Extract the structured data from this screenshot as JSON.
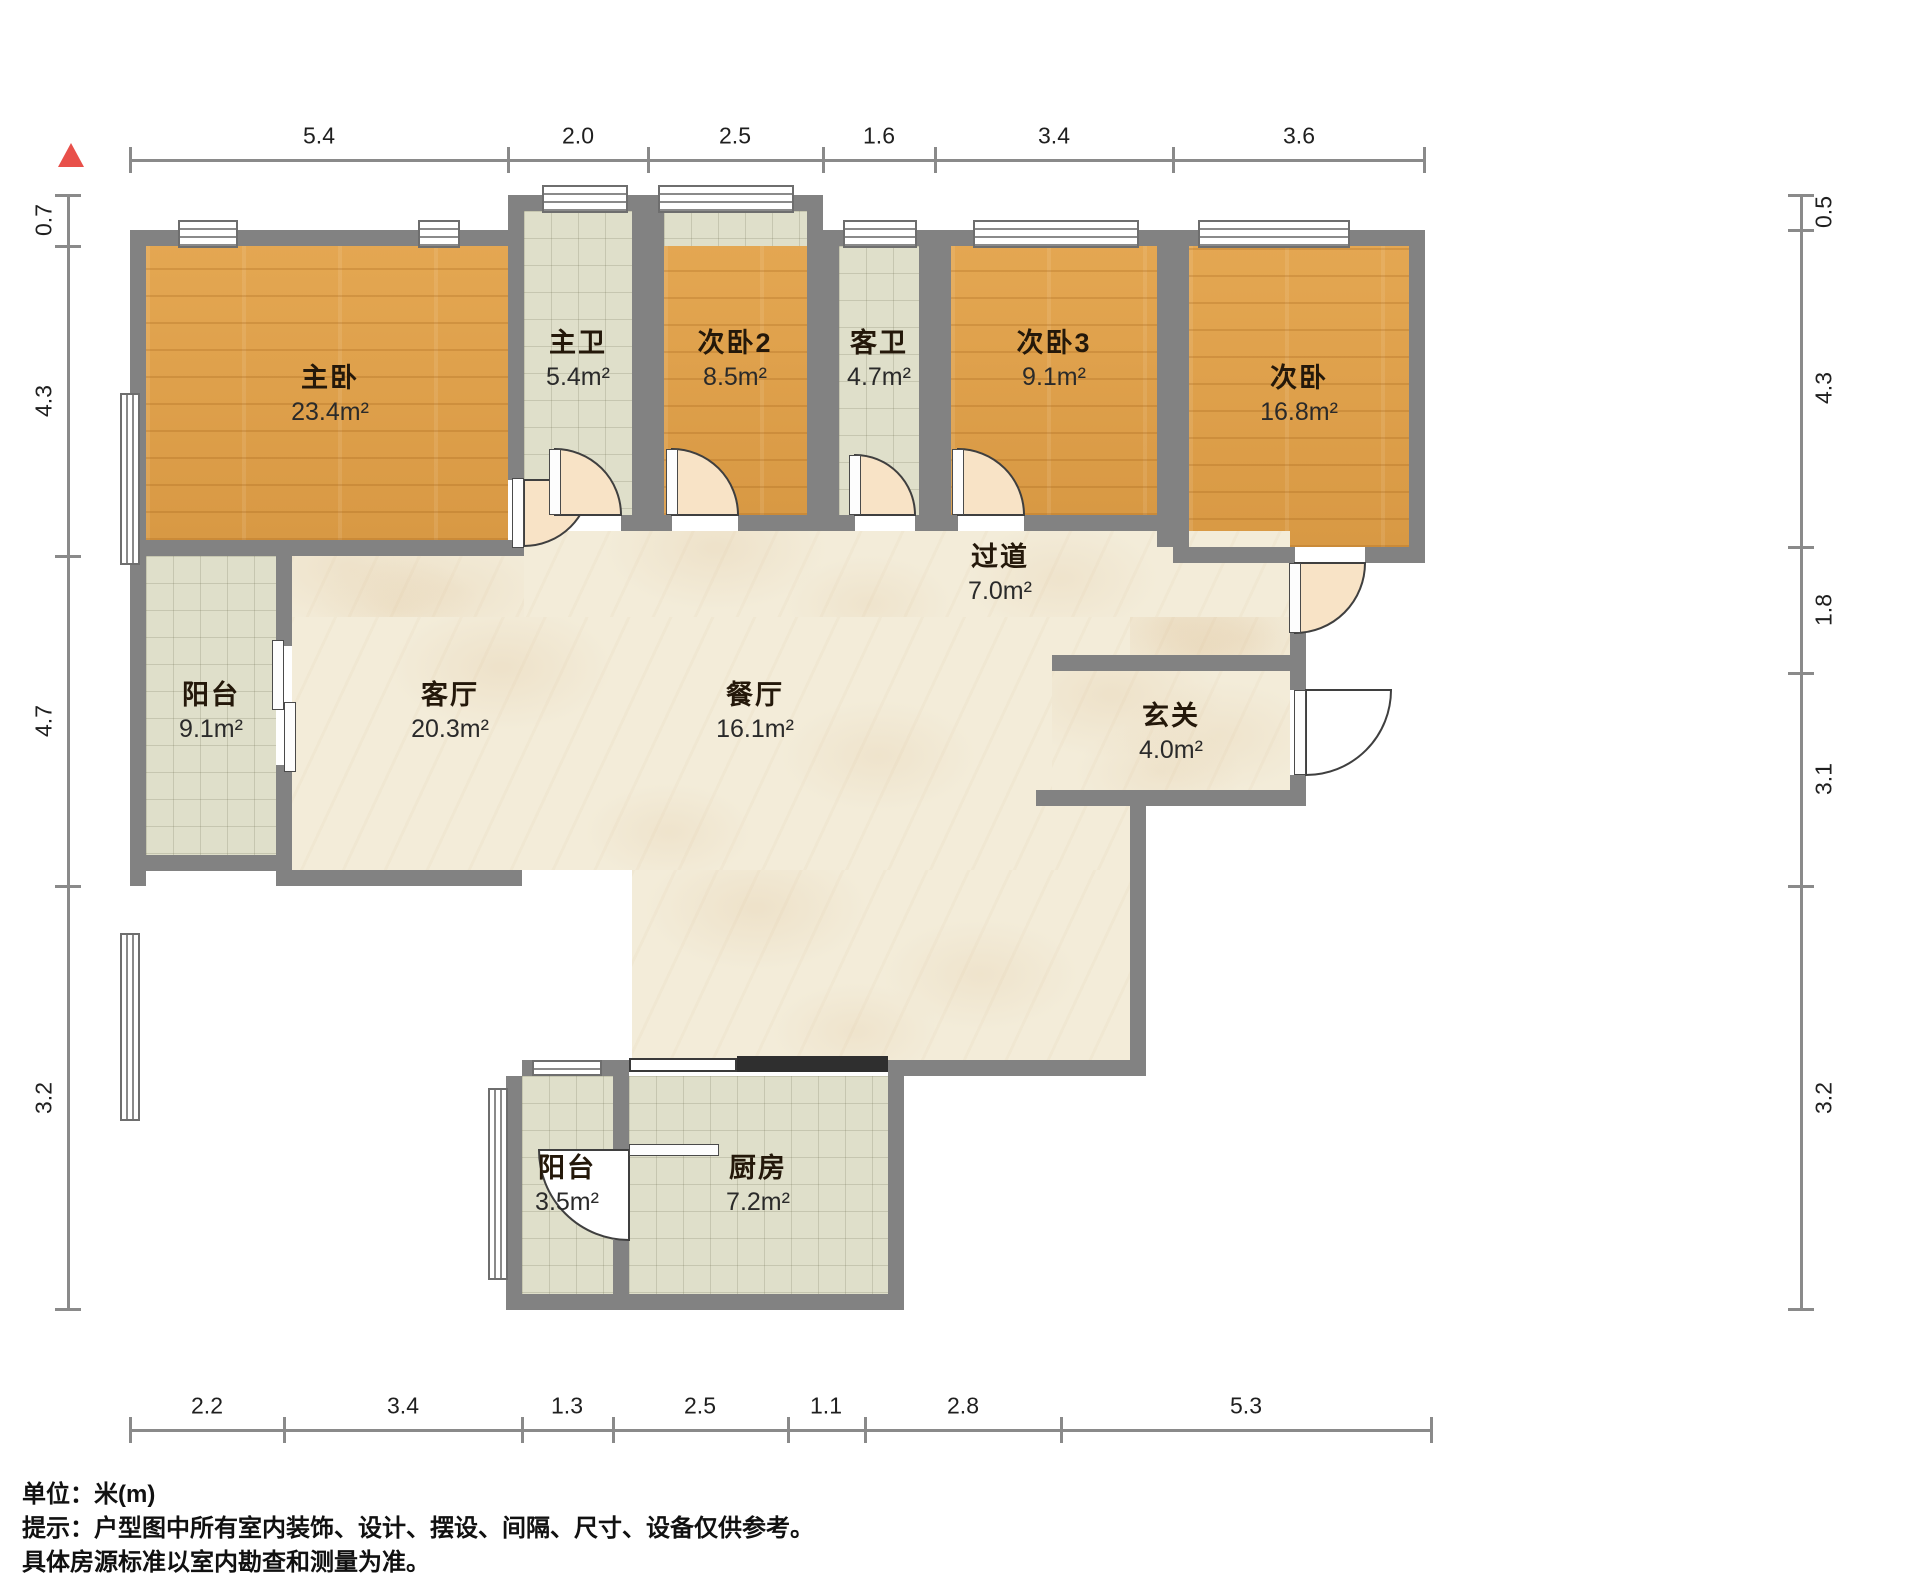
{
  "rooms": {
    "master": {
      "name": "主卧",
      "area": "23.4m²"
    },
    "master_bath": {
      "name": "主卫",
      "area": "5.4m²"
    },
    "bedroom2": {
      "name": "次卧2",
      "area": "8.5m²"
    },
    "guest_bath": {
      "name": "客卫",
      "area": "4.7m²"
    },
    "bedroom3": {
      "name": "次卧3",
      "area": "9.1m²"
    },
    "bedroom": {
      "name": "次卧",
      "area": "16.8m²"
    },
    "hallway": {
      "name": "过道",
      "area": "7.0m²"
    },
    "entry": {
      "name": "玄关",
      "area": "4.0m²"
    },
    "living": {
      "name": "客厅",
      "area": "20.3m²"
    },
    "dining": {
      "name": "餐厅",
      "area": "16.1m²"
    },
    "balcony_main": {
      "name": "阳台",
      "area": "9.1m²"
    },
    "balcony_small": {
      "name": "阳台",
      "area": "3.5m²"
    },
    "kitchen": {
      "name": "厨房",
      "area": "7.2m²"
    }
  },
  "dimensions": {
    "top": [
      "5.4",
      "2.0",
      "2.5",
      "1.6",
      "3.4",
      "3.6"
    ],
    "left": [
      "0.7",
      "4.3",
      "4.7",
      "3.2"
    ],
    "right": [
      "0.5",
      "4.3",
      "1.8",
      "3.1",
      "3.2"
    ],
    "bottom": [
      "2.2",
      "3.4",
      "1.3",
      "2.5",
      "1.1",
      "2.8",
      "5.3"
    ]
  },
  "footer": {
    "unit_label": "单位：米(m)",
    "note_line1": "提示：户型图中所有室内装饰、设计、摆设、间隔、尺寸、设备仅供参考。",
    "note_line2": "具体房源标准以室内勘查和测量为准。"
  },
  "colors": {
    "wall": "#828282",
    "wood_floor": "#dfa14b",
    "tile_floor": "#dfdfca",
    "marble_floor": "#f3ecd9",
    "door_fill": "#f8e3c6",
    "compass_red": "#e8504a"
  }
}
